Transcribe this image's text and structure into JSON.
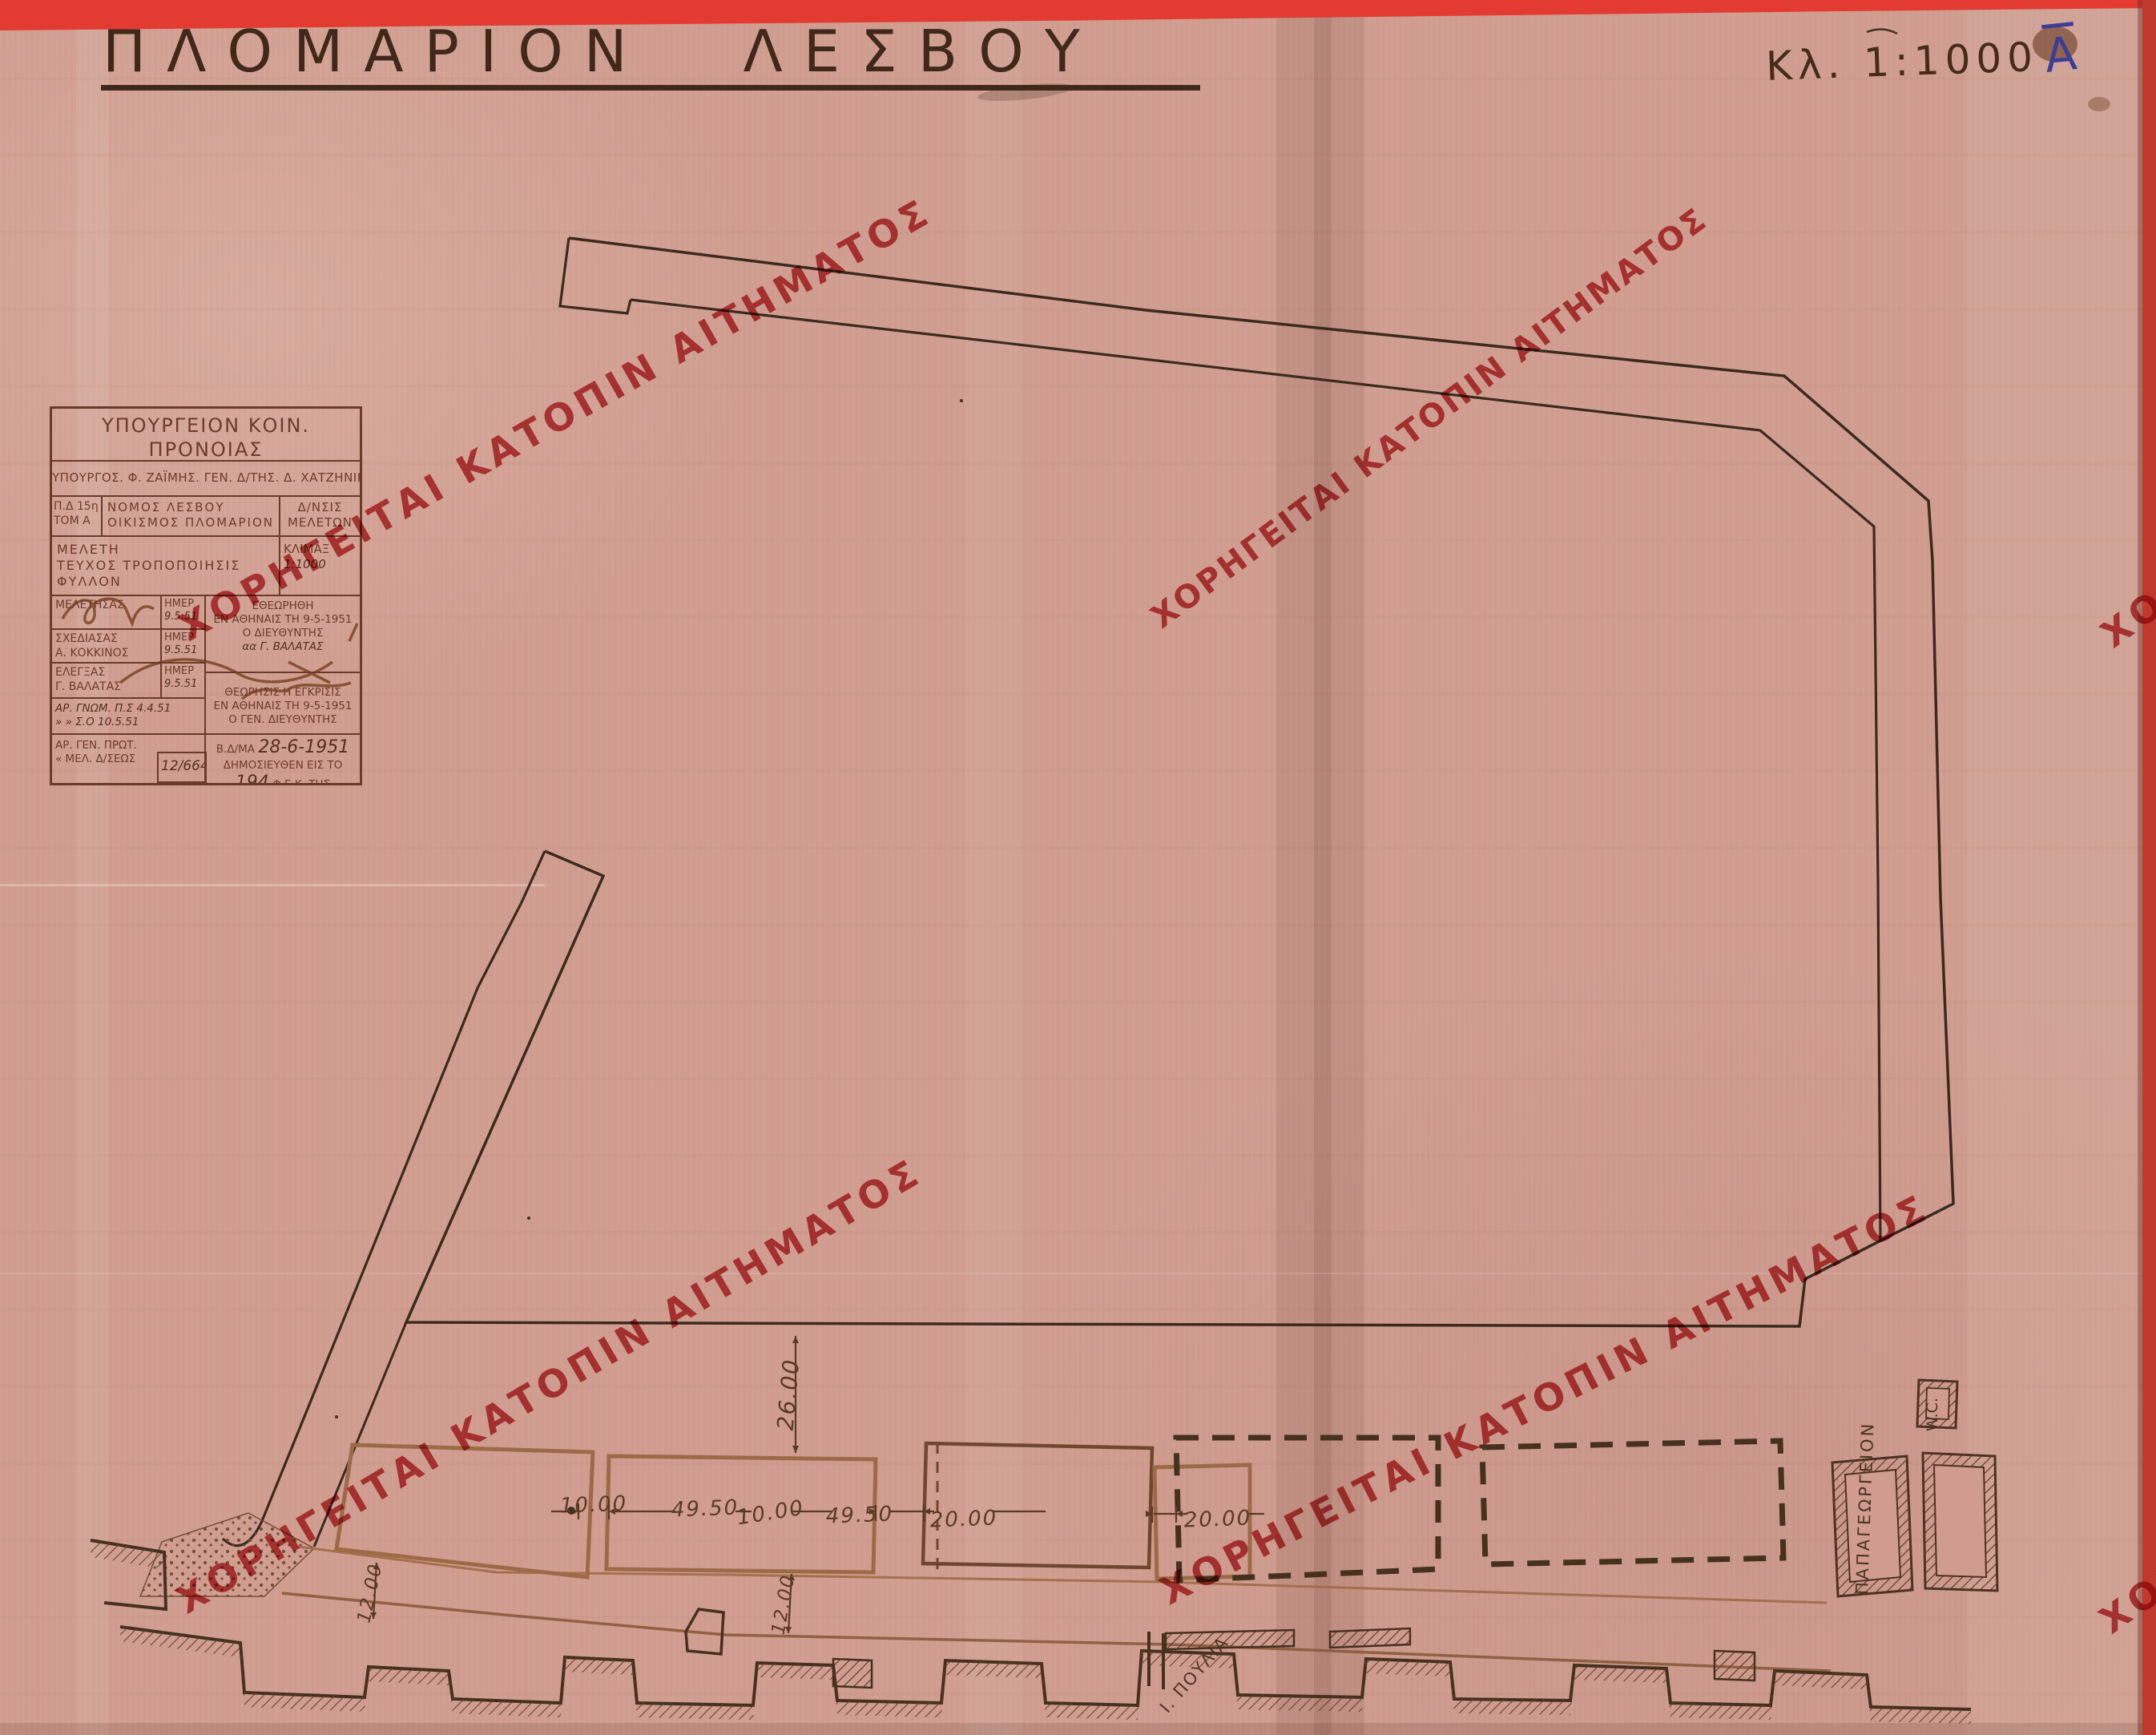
{
  "page": {
    "title": "ΠΛΟΜΑΡΙΟΝ ΛΕΣΒΟΥ",
    "scale_note": "Κλ. 1:1000",
    "sheet_letter": "A"
  },
  "watermark": {
    "text": "ΧΟΡΗΓΕΙΤΑΙ ΚΑΤΟΠΙΝ ΑΙΤΗΜΑΤΟΣ",
    "color": "#c1343a"
  },
  "title_block": {
    "header": {
      "line1": "ΥΠΟΥΡΓΕΙΟΝ ΚΟΙΝ. ΠΡΟΝΟΙΑΣ",
      "line2": "ΓΕΝΙΚΗ Δ/ΝΣΙΣ ΟΙΚΙΣΜΟΥ"
    },
    "officials": "ΥΠΟΥΡΓΟΣ. Φ. ΖΑΪΜΗΣ. ΓΕΝ. Δ/ΤΗΣ. Δ. ΧΑΤΖΗΝΙΚΟΛΗΣ",
    "ref": {
      "line1": "Π.Δ 15η",
      "line2": "ΤΟΜ Α"
    },
    "region": {
      "line1": "ΝΟΜΟΣ ΛΕΣΒΟΥ",
      "line2": "ΟΙΚΙΣΜΟΣ ΠΛΟΜΑΡΙΟΝ"
    },
    "directorate": {
      "line1": "Δ/ΝΣΙΣ",
      "line2": "ΜΕΛΕΤΩΝ"
    },
    "study": {
      "line1": "ΜΕΛΕΤΗ",
      "line2": "ΤΕΥΧΟΣ ΤΡΟΠΟΠΟΙΗΣΙΣ",
      "line3": "ΦΥΛΛΟΝ"
    },
    "scale": {
      "label": "ΚΛΙΜΑΞ",
      "value": "1:1000"
    },
    "staff": [
      {
        "role": "ΜΕΛΕΤΗΣΑΣ",
        "name": "",
        "date_label": "ΗΜΕΡ",
        "date": "9.5.51"
      },
      {
        "role": "ΣΧΕΔΙΑΣΑΣ",
        "name": "Α. ΚΟΚΚΙΝΟΣ",
        "date_label": "ΗΜΕΡ",
        "date": "9.5.51"
      },
      {
        "role": "ΕΛΕΓΞΑΣ",
        "name": "Γ. ΒΑΛΑΤΑΣ",
        "date_label": "ΗΜΕΡ",
        "date": "9.5.51"
      }
    ],
    "review": {
      "line1": "ΕΘΕΩΡΗΘΗ",
      "line2": "ΕΝ ΑΘΗΝΑΙΣ ΤΗ 9-5-1951",
      "line3": "Ο ΔΙΕΥΘΥΝΤΗΣ",
      "line4": "αα Γ. ΒΑΛΑΤΑΣ"
    },
    "opinions": {
      "line1": "ΑΡ. ΓΝΩΜ. Π.Σ 4.4.51",
      "line2": "»  »  Σ.Ο 10.5.51"
    },
    "approval": {
      "line1": "ΘΕΩΡΗΣΙΣ Η ΕΓΚΡΙΣΙΣ",
      "line2": "ΕΝ ΑΘΗΝΑΙΣ ΤΗ 9-5-1951",
      "line3": "Ο ΓΕΝ. ΔΙΕΥΘΥΝΤΗΣ"
    },
    "protocol": {
      "line1": "ΑΡ. ΓΕΝ. ΠΡΩΤ.",
      "line2": "« ΜΕΛ. Δ/ΣΕΩΣ",
      "number": "12/664"
    },
    "decree": {
      "prefix": "Β.Δ/ΜΑ",
      "date": "28-6-1951",
      "line2": "ΔΗΜΟΣΙΕΥΘΕΝ ΕΙΣ ΤΟ",
      "number": "194",
      "suffix": "Φ.Ε.Κ. ΤΗΣ"
    }
  },
  "plan": {
    "h_dims": [
      "10.00",
      "49.50",
      "10.00",
      "49.50",
      "20.00",
      "20.00"
    ],
    "v_dims": [
      "26.00",
      "12.00",
      "12.00"
    ],
    "labels": {
      "wc": "W.C.",
      "building": "ΠΑΠΑΓΕΩΡΓΕΙΟΝ",
      "coast_point": "Ι. ΠΟΥΛΙΑ"
    }
  },
  "colors": {
    "paper": "#cf9c8f",
    "ink": "#3c2a1e",
    "sepia": "#9c6a46",
    "stamp_red": "#c1343a",
    "bar_red": "#e33b31",
    "pen_blue": "#3c3e96"
  }
}
